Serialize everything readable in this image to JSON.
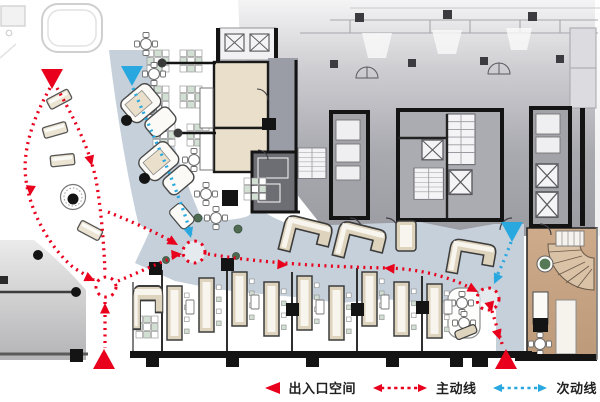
{
  "legend": {
    "items": [
      {
        "id": "entrance-space",
        "label": "出入口空间",
        "symbol": "triangle",
        "color": "#e8001c"
      },
      {
        "id": "main-route",
        "label": "主动线",
        "symbol": "dashed-arrow",
        "color": "#e8001c"
      },
      {
        "id": "secondary-route",
        "label": "次动线",
        "symbol": "dashed-arrow",
        "color": "#29a8e0"
      }
    ]
  },
  "palette": {
    "main_route_red": "#e8001c",
    "secondary_route_blue": "#29a8e0",
    "walkway_band": "#c5d0da",
    "room_beige": "#e9dfca",
    "booth_beige": "#ded3bd",
    "core_gray": "#a6a6ad",
    "dark_room_gray": "#6d6d74",
    "stair_zone_brown": "#c4a183",
    "wall_black": "#141414"
  },
  "circulation": {
    "main_color": "#e8001c",
    "secondary_color": "#29a8e0",
    "routes": [
      {
        "type": "main",
        "path": "M 50,88 C 32,120 22,152 26,180 C 30,212 50,248 74,268 L 94,280"
      },
      {
        "type": "main",
        "path": "M 57,88 C 74,118 90,150 96,180 C 101,208 104,244 105,274"
      },
      {
        "type": "main",
        "path": "M 105,302 L 105,348"
      },
      {
        "type": "main",
        "path": "M 108,212 C 128,220 156,232 176,244"
      },
      {
        "type": "main",
        "path": "M 118,281 C 140,272 160,262 180,255"
      },
      {
        "type": "main",
        "path": "M 208,254 C 262,263 330,267 388,268 C 424,269 456,279 476,291"
      },
      {
        "type": "main",
        "path": "M 492,311 L 503,347"
      },
      {
        "type": "secondary",
        "path": "M 133,88 C 147,122 166,162 178,196 C 184,212 189,226 191,236"
      },
      {
        "type": "secondary",
        "path": "M 511,242 C 506,256 500,270 494,282"
      }
    ],
    "nodes": [
      {
        "type": "main",
        "x": 106,
        "y": 287,
        "r": 10
      },
      {
        "type": "main",
        "x": 194,
        "y": 252,
        "r": 11
      },
      {
        "type": "main",
        "x": 488,
        "y": 299,
        "r": 11
      }
    ],
    "arrows": [
      {
        "type": "main",
        "x": 30,
        "y": 196,
        "a": 95
      },
      {
        "type": "main",
        "x": 92,
        "y": 166,
        "a": 75
      },
      {
        "type": "main",
        "x": 95,
        "y": 281,
        "a": 25
      },
      {
        "type": "main",
        "x": 105,
        "y": 303,
        "a": -90
      },
      {
        "type": "main",
        "x": 178,
        "y": 245,
        "a": 30
      },
      {
        "type": "main",
        "x": 182,
        "y": 254,
        "a": -5
      },
      {
        "type": "main",
        "x": 288,
        "y": 265,
        "a": 4
      },
      {
        "type": "main",
        "x": 384,
        "y": 268,
        "a": 184
      },
      {
        "type": "main",
        "x": 478,
        "y": 292,
        "a": 28
      },
      {
        "type": "main",
        "x": 492,
        "y": 312,
        "a": 75
      },
      {
        "type": "main",
        "x": 500,
        "y": 340,
        "a": 72
      },
      {
        "type": "secondary",
        "x": 191,
        "y": 238,
        "a": 75
      },
      {
        "type": "secondary",
        "x": 494,
        "y": 284,
        "a": 115
      }
    ],
    "entrances": [
      {
        "type": "main",
        "x": 52,
        "y": 79,
        "dir": "down"
      },
      {
        "type": "main",
        "x": 104,
        "y": 359,
        "dir": "up"
      },
      {
        "type": "main",
        "x": 506,
        "y": 359,
        "dir": "up"
      },
      {
        "type": "secondary",
        "x": 132,
        "y": 76,
        "dir": "down"
      },
      {
        "type": "secondary",
        "x": 512,
        "y": 232,
        "dir": "down"
      }
    ]
  }
}
